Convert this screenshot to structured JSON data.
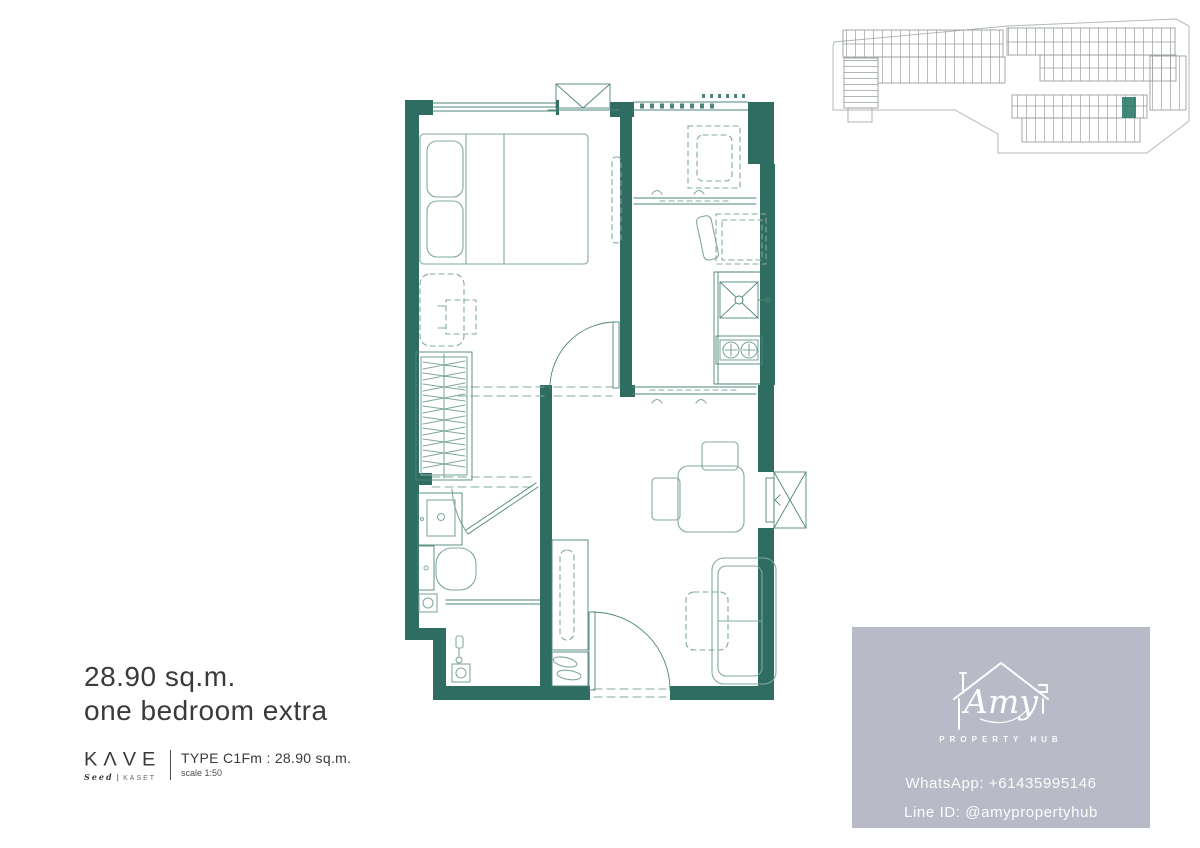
{
  "colors": {
    "wall": "#2f6c61",
    "arch_line": "#4e857b",
    "furniture_line": "#82a8a0",
    "site_line": "#98a09c",
    "site_boundary": "#b3b9b5",
    "highlight": "#2e7b6b",
    "text_dark": "#3a3a3a",
    "card_bg": "#b9bac7",
    "card_text": "#ffffff"
  },
  "title": {
    "area": "28.90 sq.m.",
    "type_name": "one bedroom extra"
  },
  "brand": {
    "name": "KΛVE",
    "sub_brand": "Seed",
    "sub_divider": "|",
    "sub_location": "KASET",
    "type_line": "TYPE C1Fm : 28.90 sq.m.",
    "scale_line": "scale 1:50"
  },
  "contact_card": {
    "logo_name": "Amy",
    "logo_tagline": "PROPERTY HUB",
    "whatsapp": "WhatsApp: +61435995146",
    "line_id": "Line ID: @amypropertyhub"
  }
}
